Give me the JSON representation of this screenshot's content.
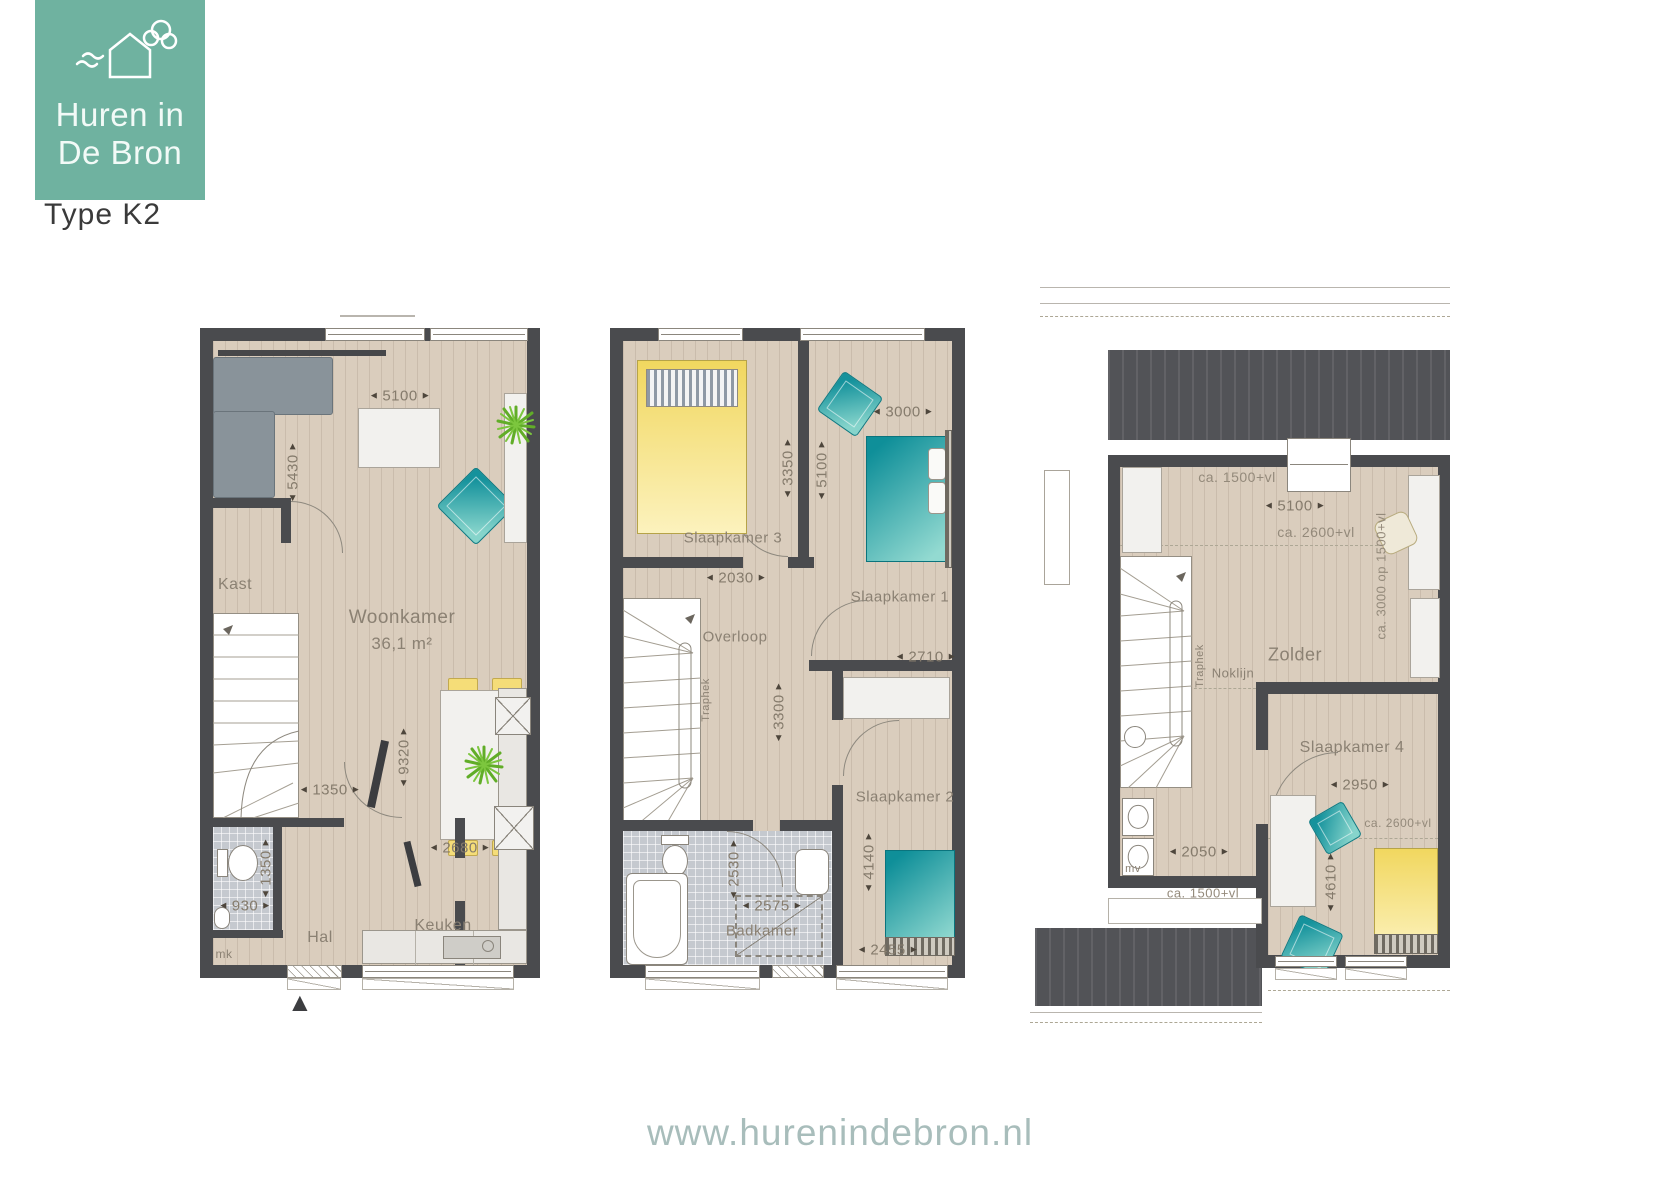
{
  "icons": {
    "arrow_left": "◄",
    "arrow_right": "►",
    "entrance_marker": "▲"
  },
  "logo": {
    "line1": "Huren in",
    "line2": "De Bron",
    "type_label": "Type K2",
    "brand_color": "#6fb2a0"
  },
  "footer": {
    "url": "www.hurenindebron.nl"
  },
  "plan1": {
    "rooms": {
      "woonkamer": "Woonkamer",
      "woonkamer_area": "36,1 m²",
      "kast": "Kast",
      "hal": "Hal",
      "mk": "mk",
      "keuken": "Keuken"
    },
    "dims": {
      "width": "5100",
      "left": "5430",
      "depth": "9320",
      "hal": "1350",
      "wc_depth": "1350",
      "wc_width": "930",
      "kitchen": "2680"
    }
  },
  "plan2": {
    "rooms": {
      "slaapkamer1": "Slaapkamer 1",
      "slaapkamer2": "Slaapkamer 2",
      "slaapkamer3": "Slaapkamer 3",
      "overloop": "Overloop",
      "badkamer": "Badkamer",
      "traphek": "Traphek"
    },
    "dims": {
      "s3_depth": "3350",
      "s3_width": "2030",
      "s1_width": "3000",
      "s1_depth": "5100",
      "closet": "2710",
      "overloop_depth": "3300",
      "bad_depth": "2530",
      "bad_width": "2575",
      "s2_depth": "4140",
      "s2_width": "2455"
    }
  },
  "plan3": {
    "rooms": {
      "zolder": "Zolder",
      "slaapkamer4": "Slaapkamer 4",
      "noklijn": "Noklijn",
      "traphek": "Traphek",
      "mv": "mv"
    },
    "dims": {
      "top_level": "ca. 1500+vl",
      "width": "5100",
      "knee_level": "ca. 2600+vl",
      "right_level": "ca. 3000 op 1500+vl",
      "s4_width": "2950",
      "s4_level": "ca. 2600+vl",
      "s4_depth": "4610",
      "left_width": "2050",
      "bottom_level": "ca. 1500+vl"
    }
  }
}
